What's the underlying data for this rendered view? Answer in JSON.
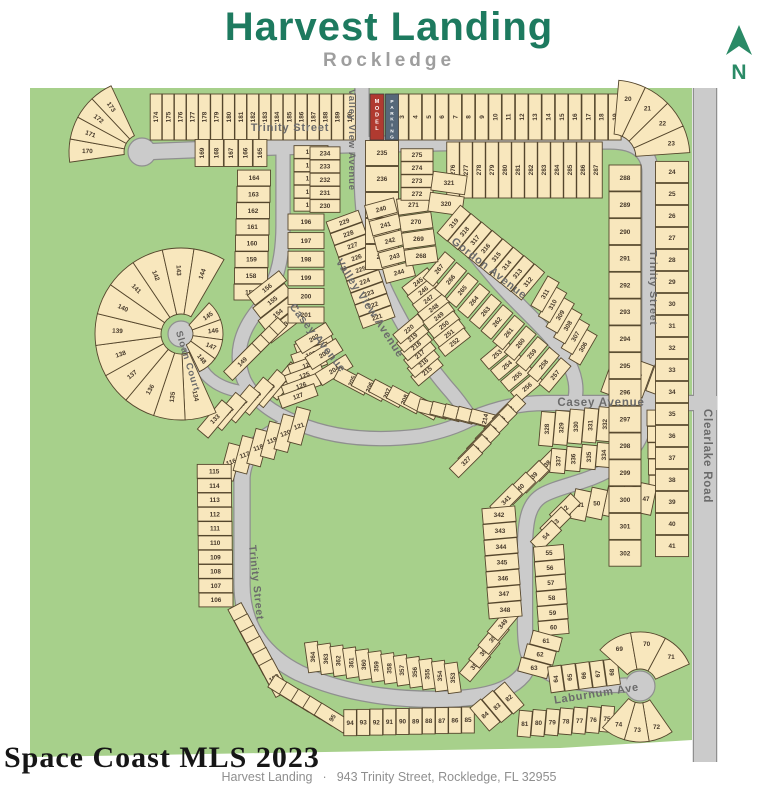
{
  "header": {
    "title": "Harvest Landing",
    "subtitle": "Rockledge"
  },
  "compass": {
    "label": "N"
  },
  "watermark": {
    "text": "Space Coast MLS 2023"
  },
  "footer": {
    "project": "Harvest Landing",
    "separator": "·",
    "address": "943 Trinity Street, Rockledge, FL 32955"
  },
  "colors": {
    "title": "#1d7a5f",
    "subtitle": "#9e9e9e",
    "compass": "#2a8a66",
    "green": "#a7d08b",
    "lot_fill": "#f8e7bd",
    "lot_border": "#55462c",
    "road_fill": "#cbcbcb",
    "road_border": "#8f8f8f",
    "street_text": "#6b6b6b",
    "lot_text": "#46392a",
    "model_bg": "#b03a30",
    "parking_bg": "#566879",
    "watermark": "#161616",
    "footer": "#8f8f8f"
  },
  "map": {
    "green_outline": "30,88 692,88 692,740 560,748 30,757",
    "roads": [
      {
        "name": "trinity-street-top-east",
        "d": "M 142,152 C 300,145 500,141 610,141 C 637,141 650,153 650,172 L 650,400",
        "w": 15
      },
      {
        "name": "valley-view-avenue",
        "d": "M 362,88 L 362,146 C 359,200 364,240 380,278 C 397,317 420,355 446,386 C 456,397 464,408 471,419",
        "w": 13
      },
      {
        "name": "casey-avenue-east",
        "d": "M 471,419 C 498,408 520,403 546,403 L 717,403",
        "w": 14
      },
      {
        "name": "gordon-avenue",
        "d": "M 450,222 C 462,240 476,256 496,280 C 520,308 548,330 565,356 C 576,374 578,390 574,402",
        "w": 13
      },
      {
        "name": "casey-avenue-west",
        "d": "M 283,146 L 283,225 C 283,262 275,288 258,310 C 240,332 234,356 244,380 C 254,400 272,413 297,423 C 337,440 380,441 420,436 C 445,431 460,425 471,419",
        "w": 13
      },
      {
        "name": "sloan-court",
        "d": "M 246,392 C 222,390 206,379 200,365 C 194,352 188,342 182,335",
        "w": 11
      },
      {
        "name": "trinity-street-west",
        "d": "M 297,423 C 264,432 244,451 242,477 L 242,584 C 242,626 263,655 299,673 C 344,694 399,701 451,699 C 491,697 511,689 523,675 C 528,668 530,661 529,656",
        "w": 15
      },
      {
        "name": "trinity-street-loop",
        "d": "M 648,403 C 646,431 636,451 616,465 C 592,482 561,485 543,495 C 529,503 525,519 525,549 L 525,624 C 525,644 527,652 529,656",
        "w": 14
      },
      {
        "name": "laburnum-ave",
        "d": "M 529,656 C 537,667 551,677 569,681 C 589,686 610,686 627,685",
        "w": 13
      },
      {
        "name": "clearlake-road",
        "d": "M 705,88 L 705,762",
        "w": 22
      }
    ],
    "bulbs": [
      {
        "x": 142,
        "y": 152,
        "r": 14
      },
      {
        "x": 181,
        "y": 334,
        "r": 13
      },
      {
        "x": 640,
        "y": 686,
        "r": 15
      }
    ],
    "special_lots": [
      {
        "label": "MODEL",
        "x": 377,
        "y": 117,
        "w": 14,
        "h": 46,
        "bg": "model_bg"
      },
      {
        "label": "PARKING",
        "x": 392,
        "y": 117,
        "w": 13,
        "h": 46,
        "bg": "parking_bg"
      }
    ],
    "street_labels": [
      {
        "text": "Trinity Street",
        "x": 290,
        "y": 131,
        "rot": 0,
        "fs": 11
      },
      {
        "text": "Valley View Avenue",
        "x": 349,
        "y": 140,
        "rot": 90,
        "fs": 9.5
      },
      {
        "text": "Valley View Avenue",
        "x": 367,
        "y": 310,
        "rot": 57,
        "fs": 11
      },
      {
        "text": "Casey Avenue",
        "x": 315,
        "y": 340,
        "rot": 52,
        "fs": 11
      },
      {
        "text": "Gordon Avenue",
        "x": 487,
        "y": 271,
        "rot": 38,
        "fs": 11
      },
      {
        "text": "Casey Avenue",
        "x": 601,
        "y": 406,
        "rot": 0,
        "fs": 11.5
      },
      {
        "text": "Trinity Street",
        "x": 650,
        "y": 288,
        "rot": 90,
        "fs": 10.5
      },
      {
        "text": "Trinity Street",
        "x": 253,
        "y": 583,
        "rot": 84,
        "fs": 10.5
      },
      {
        "text": "Sloan Court",
        "x": 185,
        "y": 362,
        "rot": 73,
        "fs": 9.5
      },
      {
        "text": "Laburnum Ave",
        "x": 597,
        "y": 697,
        "rot": -9,
        "fs": 11
      },
      {
        "text": "Clearlake Road",
        "x": 704,
        "y": 456,
        "rot": 90,
        "fs": 11.5
      }
    ],
    "lot_strips": [
      {
        "kind": "row",
        "from": 174,
        "to": 190,
        "x": 156,
        "y": 117,
        "dx": 12.1,
        "dy": 0,
        "w": 11.6,
        "h": 46,
        "rot": 0,
        "trot": -90
      },
      {
        "kind": "row",
        "from": 3,
        "to": 19,
        "x": 402,
        "y": 117,
        "dx": 13.3,
        "dy": 0,
        "w": 12.6,
        "h": 46,
        "rot": 0,
        "trot": -90
      },
      {
        "kind": "row",
        "from": 165,
        "to": 169,
        "x": 260,
        "y": 153,
        "dx": -14.5,
        "dy": 0,
        "w": 13.8,
        "h": 27,
        "rot": 0,
        "trot": -90
      },
      {
        "kind": "row",
        "from": 164,
        "to": 157,
        "x": 254,
        "y": 178,
        "dx": -0.5,
        "dy": 16.3,
        "w": 33,
        "h": 15.8
      },
      {
        "kind": "row",
        "from": 156,
        "to": 153,
        "x": 267,
        "y": 288,
        "dx": 5.4,
        "dy": 12.6,
        "w": 40,
        "h": 12.5,
        "rot": -38,
        "trot": -38
      },
      {
        "kind": "row",
        "from": 152,
        "to": 149,
        "x": 268,
        "y": 336,
        "dx": -8.6,
        "dy": 8.6,
        "w": 40,
        "h": 12.5,
        "rot": -45,
        "trot": -45
      },
      {
        "kind": "row",
        "from": 128,
        "to": 133,
        "x": 284,
        "y": 381,
        "dx": -13.8,
        "dy": 7.6,
        "w": 14,
        "h": 38,
        "rot": 40,
        "trot": -45
      },
      {
        "kind": "row",
        "from": 122,
        "to": 127,
        "x": 314,
        "y": 344,
        "dx": -3.2,
        "dy": 10.4,
        "w": 38,
        "h": 12.5,
        "rot": -20,
        "trot": -20
      },
      {
        "kind": "row",
        "from": 116,
        "to": 121,
        "x": 231,
        "y": 462,
        "dx": 13.6,
        "dy": -7.2,
        "w": 14,
        "h": 36,
        "rot": 15,
        "trot": -20
      },
      {
        "kind": "row",
        "from": 106,
        "to": 115,
        "x": 216,
        "y": 600,
        "dx": -0.2,
        "dy": -14.3,
        "w": 34,
        "h": 13.8
      },
      {
        "kind": "row",
        "from": 105,
        "to": 100,
        "x": 243,
        "y": 622,
        "dx": 6.2,
        "dy": 11.2,
        "w": 15,
        "h": 36,
        "rot": -28,
        "trot": -30
      },
      {
        "kind": "row",
        "from": 99,
        "to": 95,
        "x": 286,
        "y": 690,
        "dx": 11.6,
        "dy": 7.0,
        "w": 14,
        "h": 34,
        "rot": -58,
        "trot": -58
      },
      {
        "kind": "row",
        "from": 85,
        "to": 94,
        "x": 468,
        "y": 720,
        "dx": -13.1,
        "dy": 0.3,
        "w": 12.6,
        "h": 26
      },
      {
        "kind": "row",
        "from": 82,
        "to": 84,
        "x": 509,
        "y": 698,
        "dx": -12,
        "dy": 8.5,
        "w": 14,
        "h": 30,
        "rot": -40,
        "trot": -40
      },
      {
        "kind": "row",
        "from": 364,
        "to": 353,
        "x": 313,
        "y": 657,
        "dx": 12.7,
        "dy": 1.9,
        "w": 13,
        "h": 30,
        "rot": -8,
        "trot": -90
      },
      {
        "kind": "row",
        "from": 352,
        "to": 349,
        "x": 475,
        "y": 665,
        "dx": 9.3,
        "dy": -13.7,
        "w": 14,
        "h": 32,
        "rot": 40,
        "trot": -50
      },
      {
        "kind": "row",
        "from": 338,
        "to": 341,
        "x": 546,
        "y": 465,
        "dx": -13.3,
        "dy": 11.7,
        "w": 14,
        "h": 32,
        "rot": 45,
        "trot": -45
      },
      {
        "kind": "row",
        "from": 342,
        "to": 348,
        "x": 499,
        "y": 515,
        "dx": 1.0,
        "dy": 15.8,
        "w": 33,
        "h": 15.3,
        "rot": -5
      },
      {
        "kind": "row",
        "from": 328,
        "to": 333,
        "x": 547,
        "y": 429,
        "dx": 14.4,
        "dy": -1.2,
        "w": 13.9,
        "h": 34,
        "rot": 5,
        "trot": -90
      },
      {
        "kind": "row",
        "from": 334,
        "to": 337,
        "x": 604,
        "y": 455,
        "dx": -15.3,
        "dy": 2,
        "w": 14.8,
        "h": 24,
        "rot": 5,
        "trot": -90
      },
      {
        "kind": "row",
        "from": 303,
        "to": 305,
        "x": 661,
        "y": 378,
        "dx": -22.5,
        "dy": 0.5,
        "w": 20,
        "h": 34,
        "rot": 20,
        "trot": -70
      },
      {
        "kind": "row",
        "from": 42,
        "to": 46,
        "x": 663,
        "y": 418,
        "dx": 0.5,
        "dy": 16.3,
        "w": 32,
        "h": 15.8
      },
      {
        "kind": "row",
        "from": 47,
        "to": 51,
        "x": 646,
        "y": 499,
        "dx": -16.4,
        "dy": 1.5,
        "w": 15.8,
        "h": 30,
        "rot": 12
      },
      {
        "kind": "row",
        "from": 52,
        "to": 54,
        "x": 565,
        "y": 509,
        "dx": -9.5,
        "dy": 13.5,
        "w": 14,
        "h": 30,
        "rot": 45,
        "trot": -45
      },
      {
        "kind": "row",
        "from": 55,
        "to": 60,
        "x": 549,
        "y": 553,
        "dx": 0.9,
        "dy": 14.9,
        "w": 30,
        "h": 14.4,
        "rot": -5
      },
      {
        "kind": "row",
        "from": 61,
        "to": 63,
        "x": 546,
        "y": 641,
        "dx": -6,
        "dy": 13.5,
        "w": 30,
        "h": 14,
        "rot": 15
      },
      {
        "kind": "row",
        "from": 64,
        "to": 68,
        "x": 556,
        "y": 679,
        "dx": 14.0,
        "dy": -1.7,
        "w": 13.4,
        "h": 26,
        "rot": -8,
        "trot": -90
      },
      {
        "kind": "row",
        "from": 75,
        "to": 81,
        "x": 607,
        "y": 719,
        "dx": -13.7,
        "dy": 0.8,
        "w": 13,
        "h": 26,
        "rot": 5
      },
      {
        "kind": "row",
        "from": 191,
        "to": 195,
        "x": 311,
        "y": 152,
        "dx": 0,
        "dy": 13.2,
        "w": 34,
        "h": 12.7
      },
      {
        "kind": "row",
        "from": 196,
        "to": 201,
        "x": 306,
        "y": 222,
        "dx": 0,
        "dy": 18.6,
        "w": 36,
        "h": 16
      },
      {
        "kind": "row",
        "from": 202,
        "to": 204,
        "x": 314,
        "y": 338,
        "dx": 10,
        "dy": 16,
        "w": 36,
        "h": 14,
        "rot": -32,
        "trot": -32
      },
      {
        "kind": "row",
        "from": 205,
        "to": 209,
        "x": 352,
        "y": 381,
        "dx": 17.5,
        "dy": 6.2,
        "w": 14,
        "h": 34,
        "rot": -62,
        "trot": -68
      },
      {
        "kind": "row",
        "from": 210,
        "to": 214,
        "x": 433,
        "y": 409,
        "dx": 13,
        "dy": 2.5,
        "w": 13,
        "h": 30,
        "rot": -75,
        "trot": -78
      },
      {
        "kind": "row",
        "from": 215,
        "to": 220,
        "x": 427,
        "y": 371,
        "dx": -3.6,
        "dy": -8.4,
        "w": 12,
        "h": 32,
        "rot": 50,
        "trot": -40
      },
      {
        "kind": "row",
        "from": 221,
        "to": 229,
        "x": 377,
        "y": 317,
        "dx": -4.1,
        "dy": -11.9,
        "w": 34,
        "h": 12,
        "rot": -20,
        "trot": -20
      },
      {
        "kind": "row",
        "from": 230,
        "to": 234,
        "x": 325,
        "y": 206,
        "dx": 0,
        "dy": -13.2,
        "w": 30,
        "h": 12.7
      },
      {
        "kind": "row",
        "from": 235,
        "to": 239,
        "x": 382,
        "y": 153,
        "dx": 0,
        "dy": 26,
        "w": 33,
        "h": 25
      },
      {
        "kind": "row",
        "from": 240,
        "to": 244,
        "x": 381,
        "y": 209,
        "dx": 4.5,
        "dy": 15.8,
        "w": 30,
        "h": 15,
        "rot": -15,
        "trot": -15
      },
      {
        "kind": "row",
        "from": 245,
        "to": 252,
        "x": 418,
        "y": 282,
        "dx": 5.2,
        "dy": 8.6,
        "w": 32,
        "h": 11,
        "rot": -38,
        "trot": -38
      },
      {
        "kind": "row",
        "from": 253,
        "to": 256,
        "x": 497,
        "y": 354,
        "dx": 10,
        "dy": 11,
        "w": 32,
        "h": 13,
        "rot": -40,
        "trot": -40
      },
      {
        "kind": "row",
        "from": 257,
        "to": 267,
        "x": 555,
        "y": 375,
        "dx": -11.6,
        "dy": -10.6,
        "w": 13,
        "h": 34,
        "rot": 40,
        "trot": -50
      },
      {
        "kind": "row",
        "from": 268,
        "to": 271,
        "x": 421,
        "y": 256,
        "dx": -2.5,
        "dy": -17,
        "w": 32,
        "h": 16,
        "rot": -8
      },
      {
        "kind": "row",
        "from": 272,
        "to": 275,
        "x": 417,
        "y": 194,
        "dx": 0,
        "dy": -13,
        "w": 32,
        "h": 12.5
      },
      {
        "kind": "row",
        "from": 276,
        "to": 287,
        "x": 453,
        "y": 170,
        "dx": 13.0,
        "dy": 0,
        "w": 12.5,
        "h": 56,
        "rot": 0,
        "trot": -90
      },
      {
        "kind": "row",
        "from": 320,
        "to": 321,
        "x": 446,
        "y": 204,
        "dx": 3,
        "dy": -21,
        "w": 34,
        "h": 19,
        "rot": 8
      },
      {
        "kind": "row",
        "from": 312,
        "to": 319,
        "x": 528,
        "y": 282,
        "dx": -10.6,
        "dy": -8.4,
        "w": 13,
        "h": 36,
        "rot": 40,
        "trot": -50
      },
      {
        "kind": "row",
        "from": 306,
        "to": 311,
        "x": 583,
        "y": 347,
        "dx": -7.6,
        "dy": -10.6,
        "w": 13,
        "h": 34,
        "rot": 30,
        "trot": -60
      },
      {
        "kind": "row",
        "from": 322,
        "to": 327,
        "x": 509,
        "y": 411,
        "dx": -8.6,
        "dy": 10,
        "w": 13,
        "h": 34,
        "rot": 45,
        "trot": -45
      },
      {
        "kind": "row",
        "from": 288,
        "to": 302,
        "x": 625,
        "y": 178,
        "dx": 0,
        "dy": 26.8,
        "w": 32,
        "h": 26
      },
      {
        "kind": "row",
        "from": 24,
        "to": 41,
        "x": 672,
        "y": 172,
        "dx": 0,
        "dy": 22,
        "w": 33,
        "h": 21.2
      },
      {
        "kind": "fan",
        "from": 170,
        "to": 173,
        "cx": 142,
        "cy": 152,
        "r1": 18,
        "r2": 73,
        "a1": 172,
        "a2": 245,
        "lrot": "radial"
      },
      {
        "kind": "fan",
        "from": 20,
        "to": 23,
        "cx": 612,
        "cy": 158,
        "r1": 24,
        "r2": 78,
        "a1": 275,
        "a2": 356,
        "lrot": "flat"
      },
      {
        "kind": "fan",
        "from": 134,
        "to": 144,
        "cx": 181,
        "cy": 334,
        "r1": 20,
        "r2": 86,
        "a1": 66,
        "a2": 300,
        "lrot": "radial"
      },
      {
        "kind": "fan",
        "from": 145,
        "to": 148,
        "cx": 181,
        "cy": 334,
        "r1": 12,
        "r2": 42,
        "a1": 312,
        "a2": 424,
        "lrot": "radial"
      },
      {
        "kind": "fan",
        "from": 69,
        "to": 71,
        "cx": 640,
        "cy": 686,
        "r1": 17,
        "r2": 54,
        "a1": 222,
        "a2": 336,
        "lrot": "flat"
      },
      {
        "kind": "fan",
        "from": 72,
        "to": 74,
        "cx": 640,
        "cy": 686,
        "r1": 17,
        "r2": 56,
        "a1": 55,
        "a2": 132,
        "lrot": "flat"
      }
    ]
  }
}
